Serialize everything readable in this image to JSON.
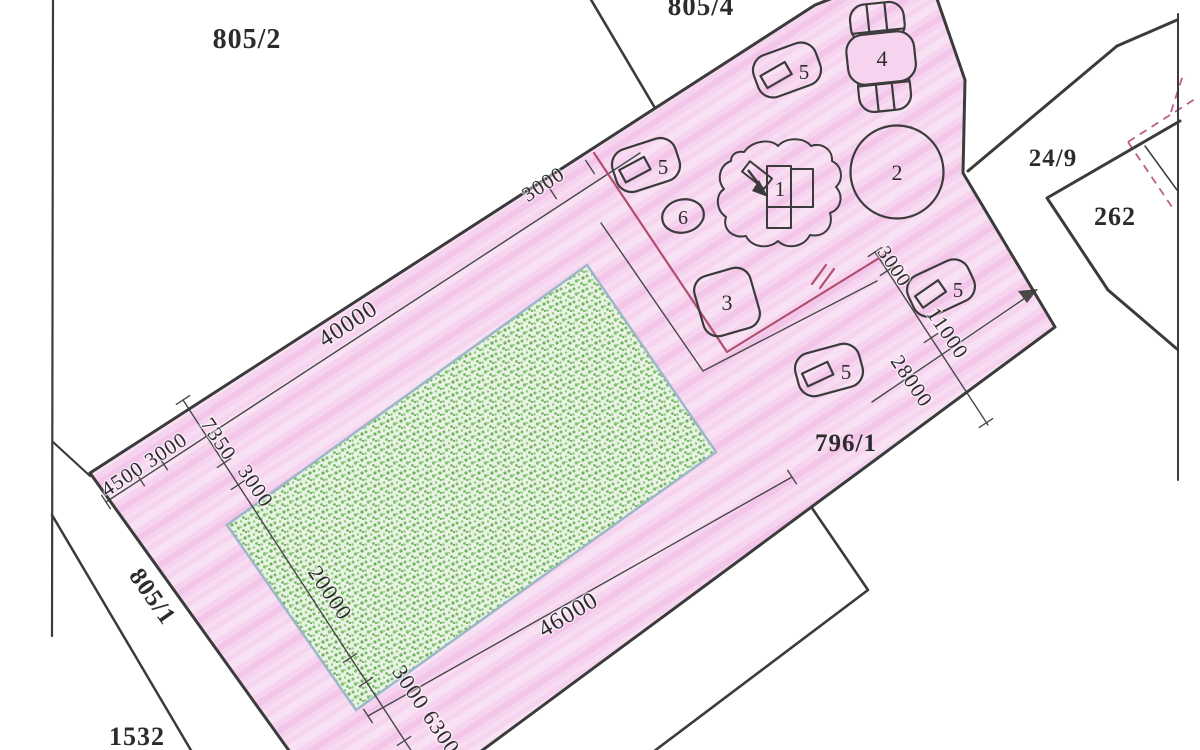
{
  "plan": {
    "parcel_labels": {
      "p805_2": "805/2",
      "p805_4": "805/4",
      "p24_9": "24/9",
      "p262": "262",
      "p796_1": "796/1",
      "p805_1": "805/1",
      "p1532": "1532"
    },
    "dimension_labels": {
      "top_edge_main": "40000",
      "top_edge_offset": "3000",
      "left_corner": "4500 3000",
      "left_margin_a": "7350",
      "left_margin_b": "3000",
      "field_width": "20000",
      "field_length": "46000",
      "bottom_margins": "3000 6300",
      "head_offset_a": "3000",
      "head_offset_b": "11000",
      "head_offset_c": "28000"
    },
    "equipment_markers": {
      "m1": "1",
      "m2": "2",
      "m3": "3",
      "m4": "4",
      "m5": "5",
      "m6": "6"
    },
    "colors": {
      "parcel_fill": "#f6d4ef",
      "field_fill": "#e9f3e3",
      "field_border": "#9cb7c9",
      "boundary": "#3b3b3b",
      "dimension_line": "#474747",
      "red_line": "#b04f6e",
      "dashed_line": "#c05a8a"
    }
  }
}
